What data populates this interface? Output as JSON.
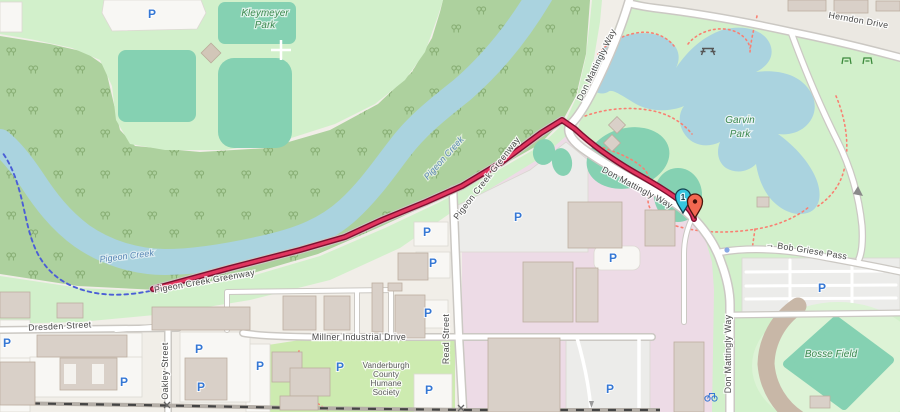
{
  "map": {
    "description": "OpenStreetMap-style map of Evansville area with highlighted Pigeon Creek Greenway route between a start and end marker",
    "route_name": "Pigeon Creek Greenway"
  },
  "labels": {
    "parks": {
      "kleymeyer_line1": "Kleymeyer",
      "kleymeyer_line2": "Park",
      "garvin_line1": "Garvin",
      "garvin_line2": "Park",
      "bosse_field": "Bosse Field"
    },
    "water": {
      "pigeon_creek": "Pigeon Creek"
    },
    "paths": {
      "greenway": "Pigeon Creek Greenway"
    },
    "streets": {
      "herndon_drive": "Herndon Drive",
      "don_mattingly_way": "Don Mattingly Way",
      "bob_griese_pass": "→ Bob Griese Pass",
      "read_street": "Read Street",
      "millner_industrial_drive": "Millner Industrial Drive",
      "dresden_street": "Dresden Street",
      "oakley_street": "Oakley Street"
    },
    "pois": {
      "humane_line1": "Vanderburgh",
      "humane_line2": "County",
      "humane_line3": "Humane",
      "humane_line4": "Society"
    }
  },
  "icons": {
    "parking": "P"
  },
  "markers": {
    "start": {
      "label": "1",
      "color": "#35c6de"
    },
    "end": {
      "color": "#f26851"
    }
  },
  "colors": {
    "water": "#aad3df",
    "forest": "#add19e",
    "park": "#d2f0cb",
    "grass": "#cdebb0",
    "pitch": "#85d1b2",
    "industrial": "#eddbe6",
    "route": "#e1355f",
    "route_casing": "#7e1030",
    "path_dotted": "#f98072",
    "cycle_dashed": "#4b5ed6",
    "grandstand": "#c8b7a7"
  }
}
